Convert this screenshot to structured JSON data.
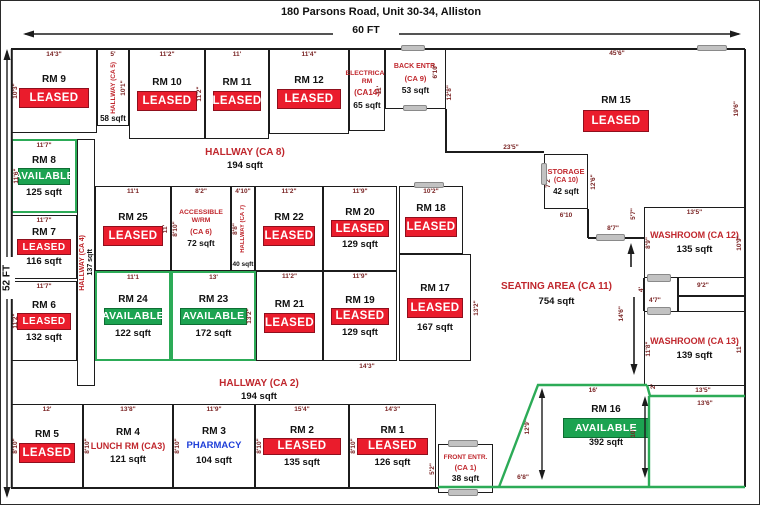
{
  "title": "180 Parsons Road, Unit 30-34, Alliston",
  "overall": {
    "width": "60 FT",
    "height": "52 FT"
  },
  "colors": {
    "leased": "#ea1c2c",
    "available": "#1ca351",
    "red_label": "#c0272d",
    "pharmacy_blue": "#1f3fd8",
    "dim_text": "#7a2424",
    "green_wall": "#2cab57",
    "wall": "#1c1c1c"
  },
  "rooms": {
    "rm9": {
      "name": "RM 9",
      "status": "LEASED",
      "dim_top": "14'3\"",
      "dim_left": "10'3\""
    },
    "hallway_ca5": {
      "name": "HALLWAY (CA 5)",
      "sqft": "58 sqft",
      "dim_top": "5'",
      "dim_right": "10'1\""
    },
    "rm10": {
      "name": "RM 10",
      "status": "LEASED",
      "dim_top": "11'2\"",
      "dim_right": "11'2\""
    },
    "rm11": {
      "name": "RM 11",
      "status": "LEASED",
      "dim_top": "11'"
    },
    "rm12": {
      "name": "RM 12",
      "status": "LEASED",
      "dim_top": "11'4\""
    },
    "electrical": {
      "name": "ELECTRICAL RM",
      "ca": "(CA14)",
      "sqft": "65 sqft",
      "dim_right": "11'"
    },
    "back_entr": {
      "name": "BACK ENTR.",
      "ca": "(CA 9)",
      "sqft": "53 sqft",
      "dim_right_top": "6'10\"",
      "dim_right": "12'8\""
    },
    "rm15": {
      "name": "RM 15",
      "status": "LEASED",
      "dim_top": "45'6\"",
      "dim_right": "19'6\""
    },
    "rm8": {
      "name": "RM 8",
      "status": "AVAILABLE",
      "sqft": "125 sqft",
      "dim_top": "11'7\"",
      "dim_left": "11'6\""
    },
    "rm7": {
      "name": "RM 7",
      "status": "LEASED",
      "sqft": "116 sqft",
      "dim_top": "11'7\""
    },
    "rm6": {
      "name": "RM 6",
      "status": "LEASED",
      "sqft": "132 sqft",
      "dim_top": "11'7\"",
      "dim_left": "11'2\""
    },
    "hallway_ca4": {
      "name": "HALLWAY (CA 4)",
      "sqft": "137 sqft"
    },
    "hallway_ca8": {
      "name": "HALLWAY (CA 8)",
      "sqft": "194 sqft"
    },
    "rm25": {
      "name": "RM 25",
      "status": "LEASED",
      "dim_top": "11'1",
      "dim_right": "11'"
    },
    "accessible": {
      "name": "ACCESSIBLE W/RM",
      "ca": "(CA 6)",
      "sqft": "72 sqft",
      "dim_top": "8'2\"",
      "dim_left": "8'10\""
    },
    "hallway_ca7": {
      "name": "HALLWAY (CA 7)",
      "sqft": "40 sqft",
      "dim_top": "4'10\"",
      "dim_left": "8'8\""
    },
    "rm22": {
      "name": "RM 22",
      "status": "LEASED",
      "dim_top": "11'2\""
    },
    "rm20": {
      "name": "RM 20",
      "status": "LEASED",
      "sqft": "129 sqft",
      "dim_top": "11'9\""
    },
    "rm18": {
      "name": "RM 18",
      "status": "LEASED",
      "dim_top": "10'2\""
    },
    "rm24": {
      "name": "RM 24",
      "status": "AVAILABLE",
      "sqft": "122 sqft",
      "dim_top": "11'1"
    },
    "rm23": {
      "name": "RM 23",
      "status": "AVAILABLE",
      "sqft": "172 sqft",
      "dim_top": "13'",
      "dim_right": "13'2\""
    },
    "rm21": {
      "name": "RM 21",
      "status": "LEASED",
      "dim_top": "11'2\""
    },
    "rm19": {
      "name": "RM 19",
      "status": "LEASED",
      "sqft": "129 sqft",
      "dim_top": "11'9\""
    },
    "rm17": {
      "name": "RM 17",
      "status": "LEASED",
      "sqft": "167 sqft",
      "dim_right": "13'2\""
    },
    "storage": {
      "name": "STORAGE",
      "ca": "(CA 10)",
      "sqft": "42 sqft",
      "dim_left": "7'2\"",
      "dim_right": "12'6\"",
      "dim_bottom": "6'10"
    },
    "washroom12": {
      "name": "WASHROOM (CA 12)",
      "sqft": "135 sqft",
      "dim_top": "13'5\"",
      "dim_left": "8'9\"",
      "dim_right": "10'9\"",
      "dim_bottom": "9'2\""
    },
    "washroom13": {
      "name": "WASHROOM (CA 13)",
      "sqft": "139 sqft",
      "dim_left": "11'8\"",
      "dim_right": "11'"
    },
    "seating": {
      "name": "SEATING AREA (CA 11)",
      "sqft": "754 sqft"
    },
    "hallway_ca2": {
      "name": "HALLWAY (CA 2)",
      "sqft": "194 sqft"
    },
    "rm5": {
      "name": "RM 5",
      "status": "LEASED",
      "dim_top": "12'",
      "dim_left": "8'10\""
    },
    "rm4": {
      "name": "RM 4",
      "label": "LUNCH RM (CA3)",
      "sqft": "121 sqft",
      "dim_top": "13'8\"",
      "dim_left": "8'10\""
    },
    "rm3": {
      "name": "RM 3",
      "label": "PHARMACY",
      "sqft": "104 sqft",
      "dim_top": "11'9\"",
      "dim_left": "8'10\""
    },
    "rm2": {
      "name": "RM 2",
      "status": "LEASED",
      "sqft": "135 sqft",
      "dim_top": "15'4\"",
      "dim_left": "8'10\""
    },
    "rm1": {
      "name": "RM 1",
      "status": "LEASED",
      "sqft": "126 sqft",
      "dim_top": "14'3\"",
      "dim_left": "8'10\""
    },
    "front_entr": {
      "name": "FRONT ENTR.",
      "ca": "(CA 1)",
      "sqft": "38 sqft",
      "dim_left": "5'2\""
    },
    "rm16": {
      "name": "RM 16",
      "status": "AVAILABLE",
      "sqft": "392 sqft",
      "dim_top": "16'",
      "dim_left": "12'9\"",
      "dim_right": "10'",
      "dim_bottom": "6'8\""
    }
  },
  "free_dims": {
    "d23_5": "23'5\"",
    "d8_7": "8'7\"",
    "d14_3": "14'3\"",
    "d14_6": "14'6\"",
    "d4": "4'",
    "d4_7": "4'7\"",
    "d5_7": "5'7\"",
    "d13_5": "13'5\"",
    "d13_6": "13'6\"",
    "d2": "2'"
  }
}
